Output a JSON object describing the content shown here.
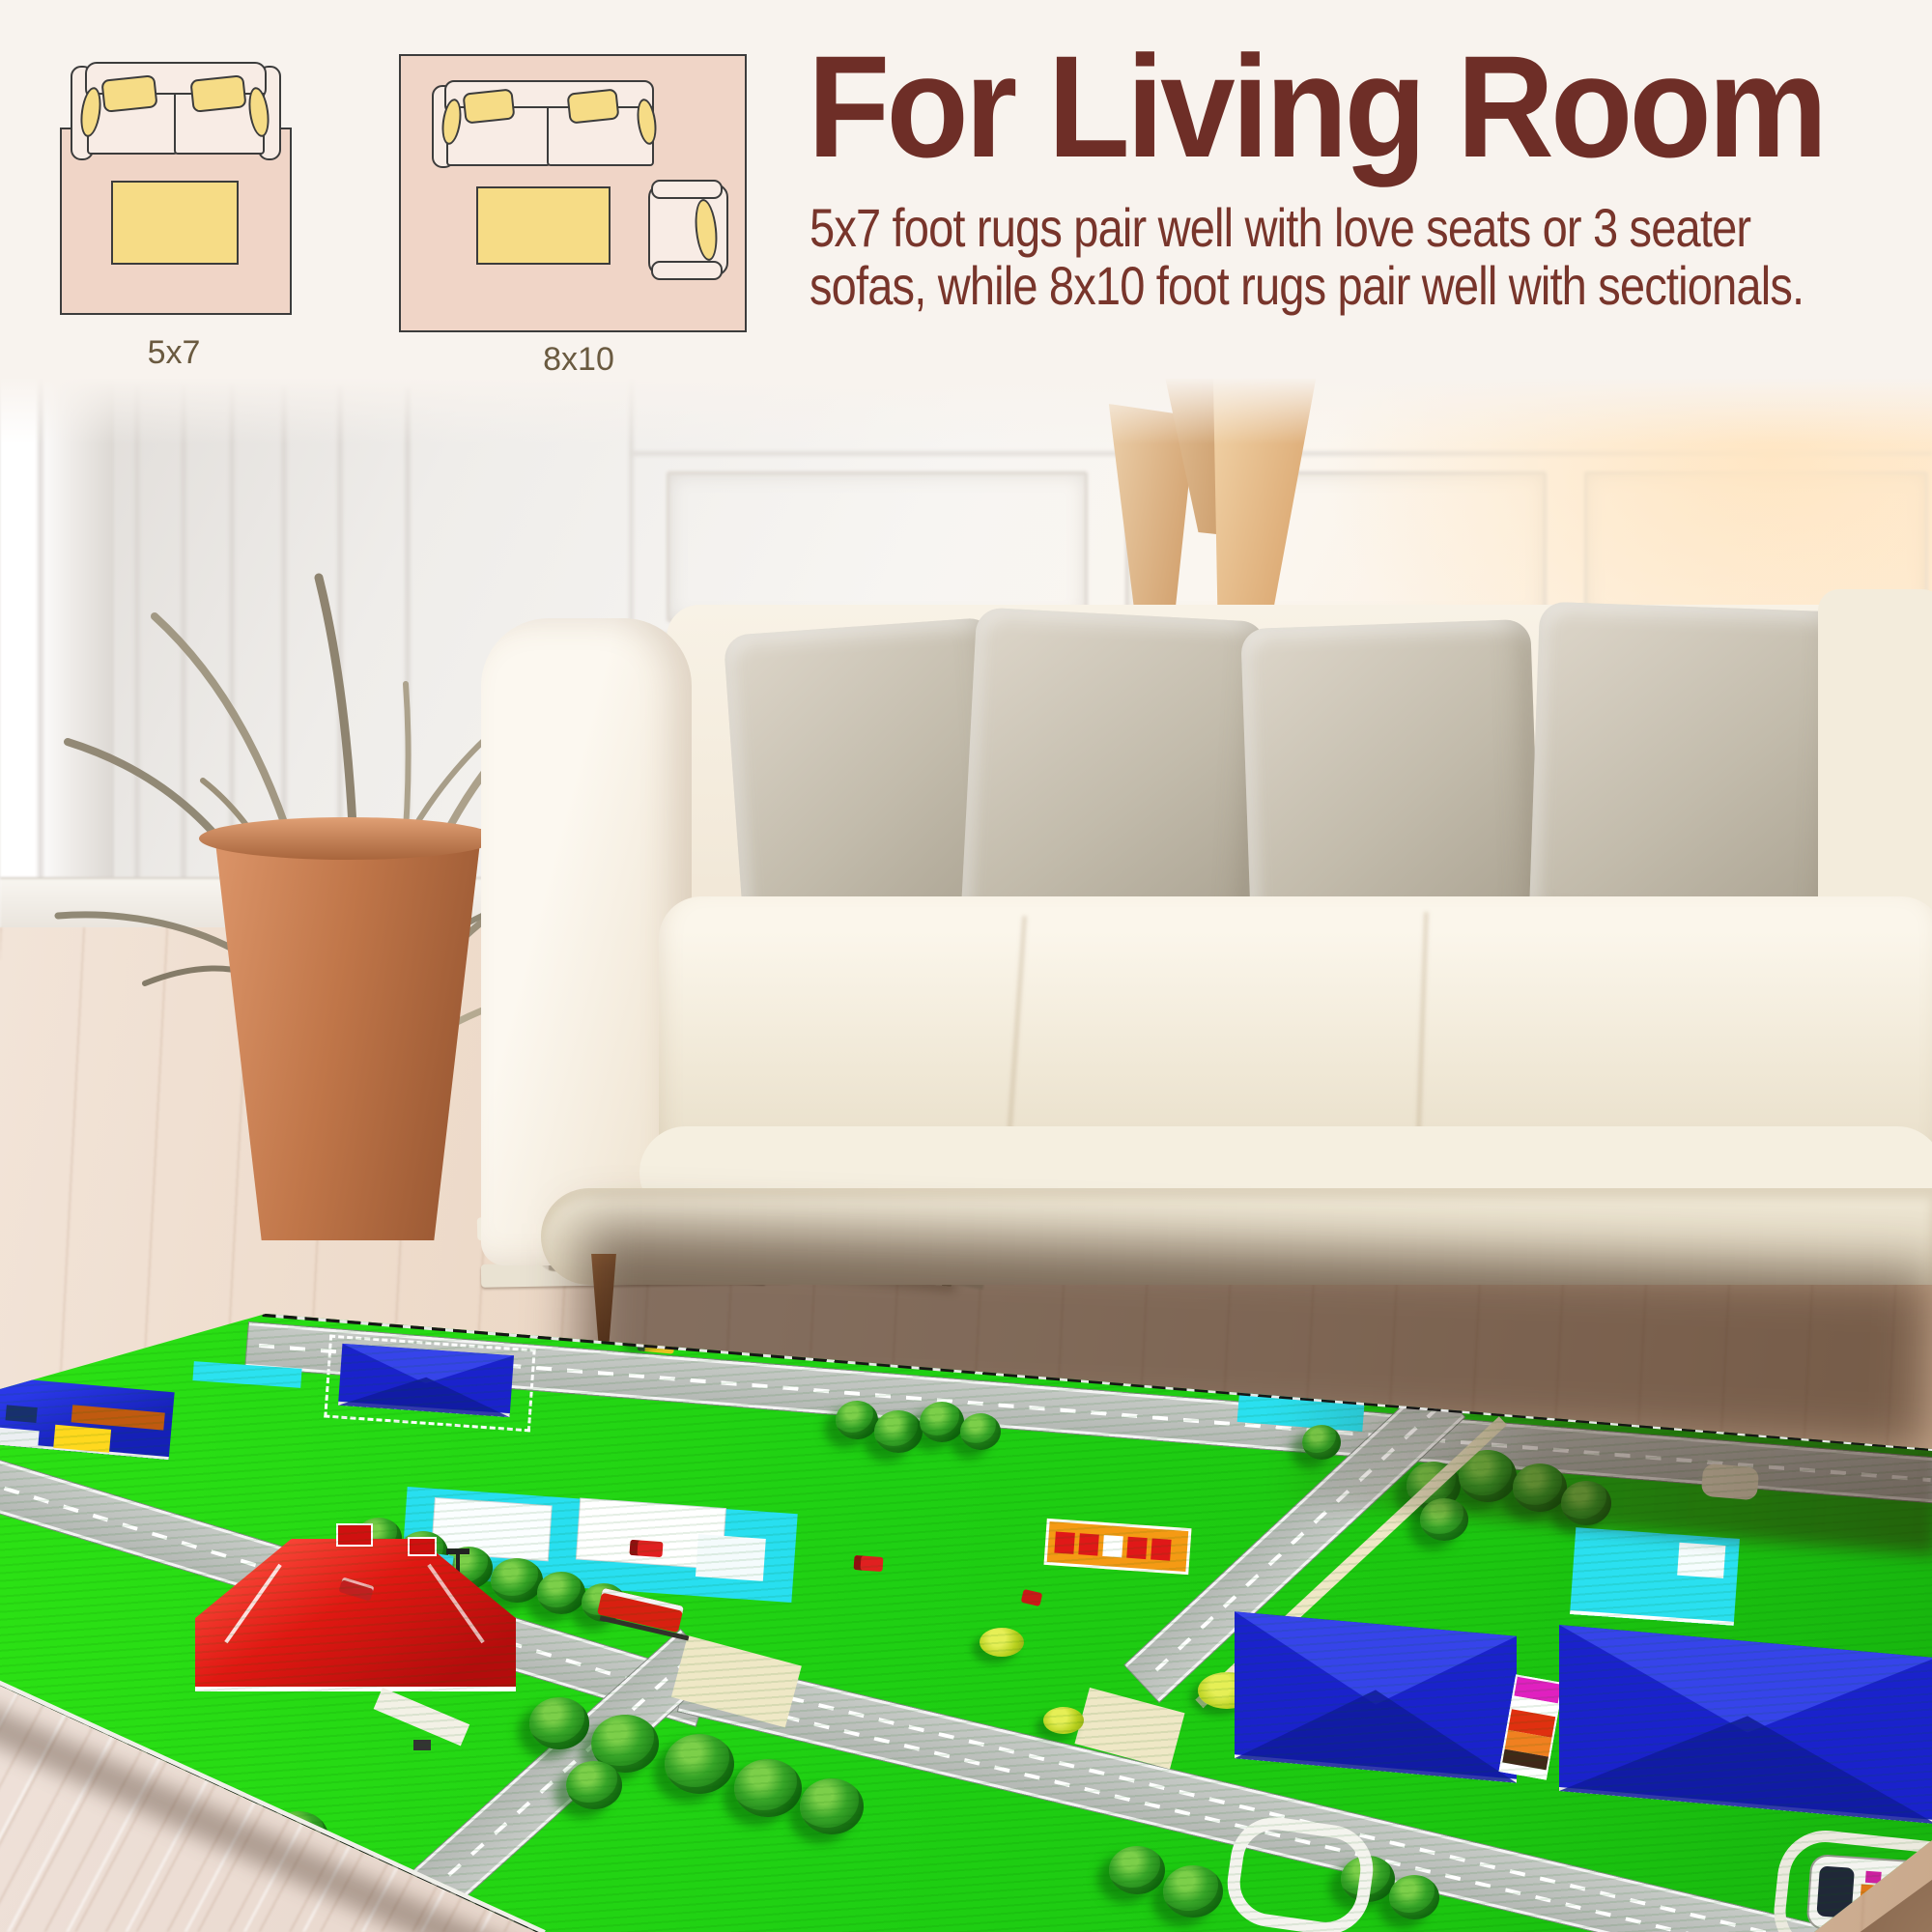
{
  "header": {
    "title": "For Living Room",
    "title_color": "#6e2e27",
    "body_line1": "5x7 foot rugs pair well with love seats or 3 seater",
    "body_line2": "sofas, while 8x10 foot rugs pair well with sectionals.",
    "body_color": "#78352b"
  },
  "size_diagrams": {
    "label_color": "#6a5a40",
    "rug_fill": "#f0d5c7",
    "sofa_fill": "#f8ece5",
    "cushion_fill": "#f6dc86",
    "outline_color": "#3c3c3c",
    "items": [
      {
        "label": "5x7"
      },
      {
        "label": "8x10"
      }
    ]
  },
  "scene_palette": {
    "background": "#f8f3ee",
    "rug_grass": "#1fd013",
    "road_gray": "#b9bdb9",
    "sidewalk_cream": "#efe8c6",
    "roof_blue": "#1a22cc",
    "roof_red": "#d81414",
    "pool_cyan": "#2ae0f0",
    "sofa_cream": "#f5efe2",
    "pot_terracotta": "#b06a42",
    "wood_floor": "#e4cdb8"
  }
}
